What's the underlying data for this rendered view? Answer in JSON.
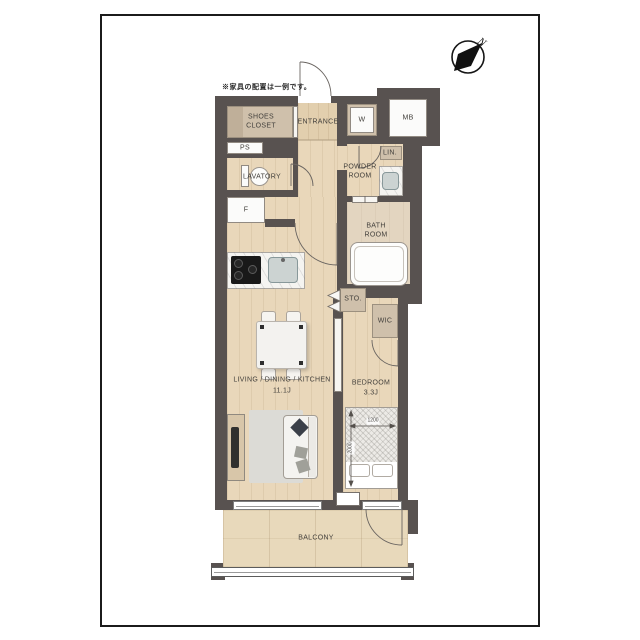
{
  "page": {
    "title_note": "※家具の配置は一例です。"
  },
  "compass": {
    "label": "N"
  },
  "rooms": {
    "shoes_closet": [
      "SHOES",
      "CLOSET"
    ],
    "entrance": "ENTRANCE",
    "washer": "W",
    "meter_box": "MB",
    "pipe_space": "PS",
    "lavatory": "LAVATORY",
    "refrigerator": "F",
    "powder_room": [
      "POWDER",
      "ROOM"
    ],
    "linen": "LIN.",
    "bath_room": [
      "BATH",
      "ROOM"
    ],
    "storage": "STO.",
    "walk_in_closet": "WIC",
    "ldk": {
      "name": "LIVING / DINING / KITCHEN",
      "size": "11.1J"
    },
    "bedroom": {
      "name": "BEDROOM",
      "size": "3.3J"
    },
    "balcony": "BALCONY"
  },
  "bed": {
    "width_mm": "1200",
    "length_mm": "2000"
  },
  "colors": {
    "wall": "#585250",
    "wood_floor": "#e9d7ba",
    "closet_floor": "#cfc0ab",
    "balcony_floor": "#e8d9bb",
    "fixture_white": "#fbfbfa",
    "frame": "#1b1b1b"
  }
}
